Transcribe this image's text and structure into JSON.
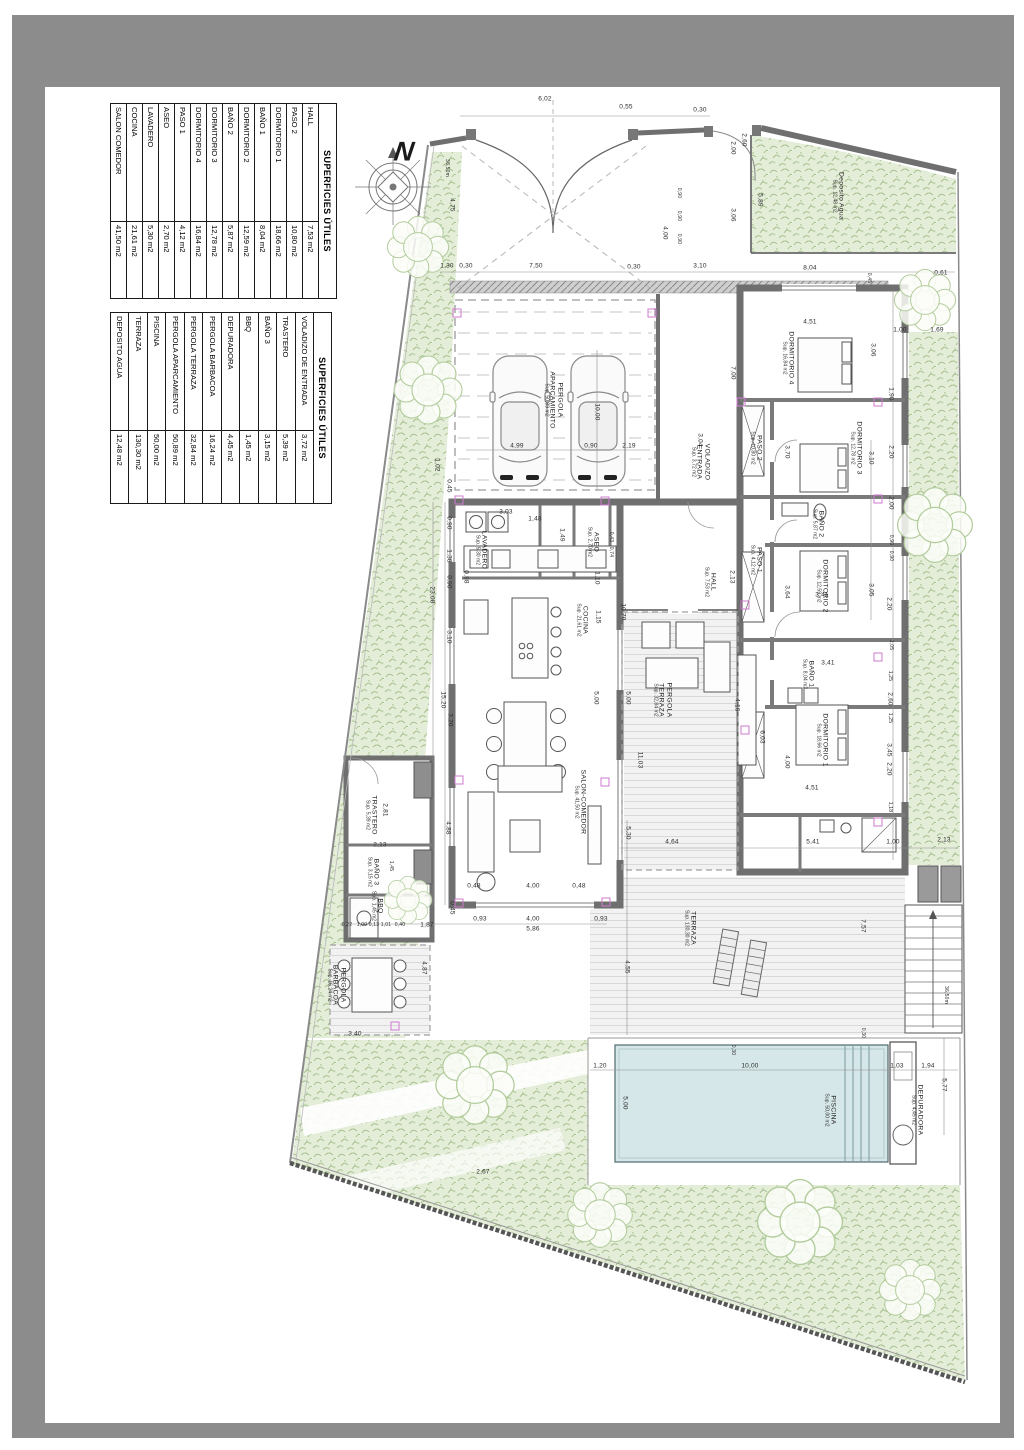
{
  "frame": {
    "outer_color": "#8c8c8c",
    "paper_color": "#ffffff"
  },
  "compass": {
    "label": "N"
  },
  "tables": [
    {
      "title": "SUPERFICIES ÚTILES",
      "rows": [
        {
          "name": "HALL",
          "value": "7,53 m2"
        },
        {
          "name": "PASO 2",
          "value": "10,80 m2"
        },
        {
          "name": "DORMITORIO 1",
          "value": "18,66 m2"
        },
        {
          "name": "BAÑO 1",
          "value": "8,04 m2"
        },
        {
          "name": "DORMITORIO 2",
          "value": "12,59 m2"
        },
        {
          "name": "BAÑO 2",
          "value": "5,87 m2"
        },
        {
          "name": "DORMITORIO 3",
          "value": "12,78 m2"
        },
        {
          "name": "DORMITORIO 4",
          "value": "16,84 m2"
        },
        {
          "name": "PASO 1",
          "value": "4,12 m2"
        },
        {
          "name": "ASEO",
          "value": "2,70 m2"
        },
        {
          "name": "LAVADERO",
          "value": "5,30 m2"
        },
        {
          "name": "COCINA",
          "value": "21,61 m2"
        },
        {
          "name": "SALON COMEDOR",
          "value": "41,50 m2"
        }
      ]
    },
    {
      "title": "SUPERFICIES ÚTILES",
      "rows": [
        {
          "name": "VOLADIZO DE ENTRADA",
          "value": "3,72 m2"
        },
        {
          "name": "TRASTERO",
          "value": "5,39 m2"
        },
        {
          "name": "BAÑO 3",
          "value": "3,15 m2"
        },
        {
          "name": "BBQ",
          "value": "1,45 m2"
        },
        {
          "name": "DEPURADORA",
          "value": "4,45 m2"
        },
        {
          "name": "PERGOLA BARBACOA",
          "value": "16,24 m2"
        },
        {
          "name": "PERGOLA TERRAZA",
          "value": "32,84 m2"
        },
        {
          "name": "PERGOLA APARCAMIENTO",
          "value": "50,89 m2"
        },
        {
          "name": "PISCINA",
          "value": "50,00 m2"
        },
        {
          "name": "TERRAZA",
          "value": "130,30 m2"
        },
        {
          "name": "DEPOSITO AGUA",
          "value": "12,48 m2"
        }
      ]
    }
  ],
  "plan": {
    "colors": {
      "vegetation": "#e4edd8",
      "vegetation_stroke": "#a3bf8c",
      "pool": "#d6e7e9",
      "wall": "#6f6f6f",
      "marker": "#cf7bcf",
      "stripe_floor": "#f2f2f2"
    },
    "rooms": [
      {
        "n": "PERGOLA",
        "s": "APARCAMIENTO",
        "a": "Sup. 50,89 m2",
        "x": 553,
        "y": 400
      },
      {
        "n": "VOLADIZO",
        "s": "ENTRADA",
        "a": "Sup. 3,72 m2",
        "x": 700,
        "y": 462
      },
      {
        "n": "Deposito Agua",
        "a": "Sup. 12,48 m2",
        "x": 838,
        "y": 196
      },
      {
        "n": "DORMITORIO 4",
        "a": "Sup. 16,84 m2",
        "x": 788,
        "y": 358
      },
      {
        "n": "DORMITORIO 3",
        "a": "Sup. 12,78 m2",
        "x": 856,
        "y": 448
      },
      {
        "n": "BAÑO 2",
        "a": "Sup. 5,87 m2",
        "x": 818,
        "y": 524
      },
      {
        "n": "DORMITORIO 2",
        "a": "Sup. 12,59 m2",
        "x": 822,
        "y": 586
      },
      {
        "n": "BAÑO 1",
        "a": "Sup. 8,04 m2",
        "x": 808,
        "y": 674
      },
      {
        "n": "DORMITORIO 1",
        "a": "Sup. 18,66 m2",
        "x": 822,
        "y": 740
      },
      {
        "n": "PASO 2",
        "a": "Sup. 10,80 m2",
        "x": 756,
        "y": 448
      },
      {
        "n": "PASO 1",
        "a": "Sup. 4,12 m2",
        "x": 756,
        "y": 560
      },
      {
        "n": "HALL",
        "a": "Sup. 7,53 m2",
        "x": 710,
        "y": 582
      },
      {
        "n": "ASEO",
        "a": "Sup. 2,70 m2",
        "x": 593,
        "y": 542
      },
      {
        "n": "LAVADERO",
        "a": "Sup. 5,30 m2",
        "x": 481,
        "y": 550
      },
      {
        "n": "COCINA",
        "a": "Sup. 21,61 m2",
        "x": 582,
        "y": 620
      },
      {
        "n": "SALON-COMEDOR",
        "a": "Sup. 41,50 m2",
        "x": 580,
        "y": 802
      },
      {
        "n": "TRASTERO",
        "a": "Sup. 5,39 m2",
        "x": 371,
        "y": 815
      },
      {
        "n": "BAÑO 3",
        "a": "Sup. 3,15 m2",
        "x": 373,
        "y": 872
      },
      {
        "n": "BBQ",
        "a": "Sup. 1,45 m2",
        "x": 377,
        "y": 906
      },
      {
        "n": "PERGOLA",
        "s": "BARBACOA",
        "a": "Sup. 16,24 m2",
        "x": 336,
        "y": 985
      },
      {
        "n": "PERGOLA",
        "s": "TERRAZA",
        "a": "Sup. 32,84 m2",
        "x": 662,
        "y": 700
      },
      {
        "n": "TERRAZA",
        "a": "Sup. 130,30 m2",
        "x": 690,
        "y": 928
      },
      {
        "n": "PISCINA",
        "a": "Sup. 50,00 m2",
        "x": 830,
        "y": 1110
      },
      {
        "n": "DEPURADORA",
        "a": "Sup. 4,45 m2",
        "x": 917,
        "y": 1110
      }
    ],
    "dims": [
      {
        "t": "6,02",
        "x": 545,
        "y": 99
      },
      {
        "t": "0,55",
        "x": 626,
        "y": 107
      },
      {
        "t": "0,30",
        "x": 700,
        "y": 110
      },
      {
        "t": "1,30",
        "x": 447,
        "y": 266
      },
      {
        "t": "0,30",
        "x": 466,
        "y": 266
      },
      {
        "t": "7,50",
        "x": 536,
        "y": 266
      },
      {
        "t": "0,30",
        "x": 634,
        "y": 267
      },
      {
        "t": "3,10",
        "x": 700,
        "y": 266
      },
      {
        "t": "8,04",
        "x": 810,
        "y": 268
      },
      {
        "t": "0,61",
        "x": 941,
        "y": 273
      },
      {
        "t": "4,75",
        "x": 452,
        "y": 205,
        "v": 1
      },
      {
        "t": "36,50m",
        "x": 447,
        "y": 168,
        "v": 1,
        "s": 5
      },
      {
        "t": "2,00",
        "x": 733,
        "y": 148,
        "v": 1
      },
      {
        "t": "3,06",
        "x": 733,
        "y": 215,
        "v": 1
      },
      {
        "t": "0,90",
        "x": 679,
        "y": 193,
        "v": 1,
        "s": 5
      },
      {
        "t": "0,90",
        "x": 679,
        "y": 216,
        "v": 1,
        "s": 5
      },
      {
        "t": "0,90",
        "x": 679,
        "y": 239,
        "v": 1,
        "s": 5
      },
      {
        "t": "4,00",
        "x": 665,
        "y": 233,
        "v": 1
      },
      {
        "t": "5,89",
        "x": 760,
        "y": 200,
        "v": 1
      },
      {
        "t": "2,60",
        "x": 744,
        "y": 140,
        "v": 1
      },
      {
        "t": "4,99",
        "x": 517,
        "y": 446
      },
      {
        "t": "0,90",
        "x": 591,
        "y": 446
      },
      {
        "t": "2,19",
        "x": 629,
        "y": 446
      },
      {
        "t": "10,00",
        "x": 597,
        "y": 412,
        "v": 1
      },
      {
        "t": "3,04",
        "x": 700,
        "y": 440,
        "v": 1
      },
      {
        "t": "1,02",
        "x": 437,
        "y": 465,
        "v": 1
      },
      {
        "t": "0,45",
        "x": 449,
        "y": 486,
        "v": 1
      },
      {
        "t": "0,90",
        "x": 449,
        "y": 523,
        "v": 1
      },
      {
        "t": "1,38",
        "x": 449,
        "y": 556,
        "v": 1
      },
      {
        "t": "0,98",
        "x": 466,
        "y": 577,
        "v": 1
      },
      {
        "t": "0,90",
        "x": 449,
        "y": 582,
        "v": 1
      },
      {
        "t": "3,10",
        "x": 449,
        "y": 637,
        "v": 1
      },
      {
        "t": "23,08",
        "x": 432,
        "y": 595,
        "v": 1
      },
      {
        "t": "15,20",
        "x": 443,
        "y": 700,
        "v": 1
      },
      {
        "t": "3,20",
        "x": 450,
        "y": 720,
        "v": 1
      },
      {
        "t": "4,88",
        "x": 448,
        "y": 828,
        "v": 1
      },
      {
        "t": "0,45",
        "x": 452,
        "y": 908,
        "v": 1
      },
      {
        "t": "0,48",
        "x": 474,
        "y": 886
      },
      {
        "t": "4,00",
        "x": 533,
        "y": 886
      },
      {
        "t": "0,48",
        "x": 579,
        "y": 886
      },
      {
        "t": "0,93",
        "x": 480,
        "y": 919
      },
      {
        "t": "4,00",
        "x": 533,
        "y": 919
      },
      {
        "t": "0,93",
        "x": 601,
        "y": 919
      },
      {
        "t": "5,86",
        "x": 533,
        "y": 929
      },
      {
        "t": "0,22",
        "x": 347,
        "y": 925,
        "s": 5
      },
      {
        "t": "1,00",
        "x": 362,
        "y": 925,
        "s": 5
      },
      {
        "t": "0,13",
        "x": 374,
        "y": 925,
        "s": 5
      },
      {
        "t": "1,01",
        "x": 386,
        "y": 925,
        "s": 5
      },
      {
        "t": "0,40",
        "x": 400,
        "y": 925,
        "s": 5
      },
      {
        "t": "1,87",
        "x": 427,
        "y": 925
      },
      {
        "t": "4,87",
        "x": 424,
        "y": 968,
        "v": 1
      },
      {
        "t": "3,40",
        "x": 355,
        "y": 1034
      },
      {
        "t": "2,81",
        "x": 385,
        "y": 810,
        "v": 1
      },
      {
        "t": "2,13",
        "x": 380,
        "y": 845
      },
      {
        "t": "1,45",
        "x": 391,
        "y": 866,
        "v": 1,
        "s": 5
      },
      {
        "t": "3,03",
        "x": 506,
        "y": 512
      },
      {
        "t": "1,48",
        "x": 535,
        "y": 519
      },
      {
        "t": "1,49",
        "x": 562,
        "y": 535,
        "v": 1
      },
      {
        "t": "0,43",
        "x": 611,
        "y": 537,
        "v": 1,
        "s": 5
      },
      {
        "t": "0,74",
        "x": 611,
        "y": 552,
        "v": 1,
        "s": 5
      },
      {
        "t": "1,10",
        "x": 597,
        "y": 578,
        "v": 1
      },
      {
        "t": "1,15",
        "x": 598,
        "y": 617,
        "v": 1
      },
      {
        "t": "10,70",
        "x": 623,
        "y": 612,
        "v": 1
      },
      {
        "t": "2,13",
        "x": 732,
        "y": 577,
        "v": 1
      },
      {
        "t": "5,00",
        "x": 596,
        "y": 698,
        "v": 1
      },
      {
        "t": "5,00",
        "x": 628,
        "y": 698,
        "v": 1
      },
      {
        "t": "11,03",
        "x": 640,
        "y": 760,
        "v": 1
      },
      {
        "t": "4,19",
        "x": 737,
        "y": 705,
        "v": 1
      },
      {
        "t": "7,00",
        "x": 733,
        "y": 373,
        "v": 1
      },
      {
        "t": "4,51",
        "x": 810,
        "y": 322
      },
      {
        "t": "3,06",
        "x": 873,
        "y": 350,
        "v": 1
      },
      {
        "t": "1,00",
        "x": 900,
        "y": 330
      },
      {
        "t": "1,69",
        "x": 937,
        "y": 330
      },
      {
        "t": "0,45",
        "x": 869,
        "y": 278,
        "v": 1,
        "s": 5
      },
      {
        "t": "3,70",
        "x": 787,
        "y": 452,
        "v": 1
      },
      {
        "t": "3,10",
        "x": 871,
        "y": 458,
        "v": 1
      },
      {
        "t": "1,90",
        "x": 891,
        "y": 394,
        "v": 1
      },
      {
        "t": "2,20",
        "x": 891,
        "y": 452,
        "v": 1
      },
      {
        "t": "2,00",
        "x": 891,
        "y": 503,
        "v": 1
      },
      {
        "t": "0,90",
        "x": 891,
        "y": 540,
        "v": 1,
        "s": 5
      },
      {
        "t": "0,90",
        "x": 891,
        "y": 556,
        "v": 1,
        "s": 5
      },
      {
        "t": "3,41",
        "x": 822,
        "y": 595
      },
      {
        "t": "3,64",
        "x": 787,
        "y": 592,
        "v": 1
      },
      {
        "t": "3,05",
        "x": 871,
        "y": 590,
        "v": 1
      },
      {
        "t": "2,20",
        "x": 889,
        "y": 604,
        "v": 1
      },
      {
        "t": "3,41",
        "x": 828,
        "y": 663
      },
      {
        "t": "1,05",
        "x": 891,
        "y": 645,
        "v": 1,
        "s": 5
      },
      {
        "t": "1,25",
        "x": 890,
        "y": 676,
        "v": 1,
        "s": 5
      },
      {
        "t": "2,60",
        "x": 890,
        "y": 699,
        "v": 1
      },
      {
        "t": "1,25",
        "x": 890,
        "y": 718,
        "v": 1,
        "s": 5
      },
      {
        "t": "6,03",
        "x": 762,
        "y": 737,
        "v": 1
      },
      {
        "t": "4,00",
        "x": 787,
        "y": 762,
        "v": 1
      },
      {
        "t": "3,45",
        "x": 889,
        "y": 750,
        "v": 1
      },
      {
        "t": "2,20",
        "x": 889,
        "y": 769,
        "v": 1
      },
      {
        "t": "4,51",
        "x": 812,
        "y": 788
      },
      {
        "t": "1,18",
        "x": 890,
        "y": 807,
        "v": 1,
        "s": 5
      },
      {
        "t": "1,00",
        "x": 893,
        "y": 842
      },
      {
        "t": "4,64",
        "x": 672,
        "y": 842
      },
      {
        "t": "5,41",
        "x": 813,
        "y": 842
      },
      {
        "t": "2,13",
        "x": 944,
        "y": 840
      },
      {
        "t": "5,30",
        "x": 628,
        "y": 833,
        "v": 1
      },
      {
        "t": "7,57",
        "x": 863,
        "y": 926,
        "v": 1
      },
      {
        "t": "4,55",
        "x": 627,
        "y": 967,
        "v": 1
      },
      {
        "t": "1,20",
        "x": 600,
        "y": 1066
      },
      {
        "t": "10,00",
        "x": 750,
        "y": 1066
      },
      {
        "t": "0,30",
        "x": 733,
        "y": 1050,
        "v": 1,
        "s": 5
      },
      {
        "t": "0,30",
        "x": 863,
        "y": 1033,
        "v": 1,
        "s": 5
      },
      {
        "t": "5,00",
        "x": 625,
        "y": 1103,
        "v": 1
      },
      {
        "t": "1,03",
        "x": 897,
        "y": 1066
      },
      {
        "t": "1,94",
        "x": 928,
        "y": 1066
      },
      {
        "t": "5,77",
        "x": 944,
        "y": 1085,
        "v": 1
      },
      {
        "t": "2,67",
        "x": 483,
        "y": 1172
      },
      {
        "t": "36,50m",
        "x": 946,
        "y": 995,
        "v": 1,
        "s": 5
      }
    ],
    "markers": [
      [
        457,
        313
      ],
      [
        652,
        313
      ],
      [
        459,
        500
      ],
      [
        605,
        501
      ],
      [
        741,
        402
      ],
      [
        878,
        402
      ],
      [
        878,
        499
      ],
      [
        878,
        657
      ],
      [
        459,
        780
      ],
      [
        605,
        782
      ],
      [
        459,
        903
      ],
      [
        606,
        902
      ],
      [
        745,
        605
      ],
      [
        745,
        730
      ],
      [
        878,
        822
      ],
      [
        395,
        1026
      ]
    ]
  }
}
